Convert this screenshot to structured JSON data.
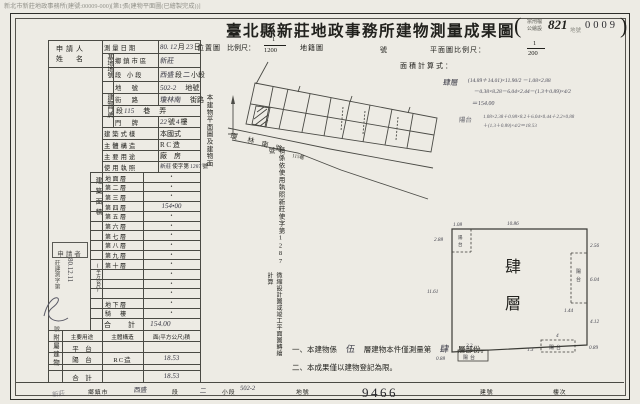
{
  "scan_header": "新北市新莊地政事務所(建號:00009-000)[第1張(建物平面圖(已繪製完成))]",
  "title": {
    "main": "臺北縣新莊地政事務所建物測量成果圖",
    "paren_open": "(",
    "paren_line1": "宗刑檔",
    "paren_line2": "公繪設",
    "file_number": "821",
    "registry_label": "地號",
    "page_number": "0009",
    "paren_close": ")"
  },
  "applicant": {
    "line1": "申請人",
    "line2": "姓　名"
  },
  "left_table": {
    "groups": [
      {
        "text": "基地地號",
        "y": 54,
        "h": 38
      },
      {
        "text": "建物門牌",
        "y": 94,
        "h": 32
      }
    ],
    "rows": [
      {
        "label": "測量日期",
        "segs": [
          {
            "t": "80.",
            "h": 1
          },
          {
            "t": "12",
            "h": 1
          },
          {
            "t": "月",
            "h": 0
          },
          {
            "t": "23",
            "h": 1
          },
          {
            "t": "日",
            "h": 0
          }
        ]
      },
      {
        "label": "鄉鎮市區",
        "inset": 1,
        "segs": [
          {
            "t": "新莊",
            "h": 1
          }
        ]
      },
      {
        "label": "段 小段",
        "inset": 1,
        "segs": [
          {
            "t": "西盛",
            "h": 1
          },
          {
            "t": "段",
            "h": 0
          },
          {
            "t": "二",
            "h": 1
          },
          {
            "t": "小段",
            "h": 0
          }
        ]
      },
      {
        "label": "地　號",
        "inset": 1,
        "segs": [
          {
            "t": "502-2",
            "h": 1
          },
          {
            "t": "地號",
            "h": 0,
            "gap": 1
          }
        ]
      },
      {
        "label": "街　路",
        "inset": 1,
        "segs": [
          {
            "t": "瓊林南",
            "h": 1
          },
          {
            "t": "街路",
            "h": 0,
            "gap": 1
          }
        ]
      },
      {
        "label": "",
        "inset": 1,
        "span": 1,
        "segs": [
          {
            "t": "段",
            "h": 0
          },
          {
            "t": "115",
            "h": 1
          },
          {
            "t": "巷",
            "h": 0,
            "gap": 1
          },
          {
            "t": "弄",
            "h": 0,
            "gap": 1
          }
        ]
      },
      {
        "label": "門　牌",
        "inset": 1,
        "segs": [
          {
            "t": "22",
            "h": 1
          },
          {
            "t": "號",
            "h": 0
          },
          {
            "t": "4",
            "h": 1
          },
          {
            "t": "樓",
            "h": 0
          }
        ]
      },
      {
        "label": "建築式樣",
        "segs": [
          {
            "t": "本國式",
            "h": 0
          }
        ]
      },
      {
        "label": "主體構造",
        "segs": [
          {
            "t": "R C 造",
            "h": 0
          }
        ]
      },
      {
        "label": "主要用途",
        "segs": [
          {
            "t": "廠　房",
            "h": 0
          }
        ]
      },
      {
        "label": "使用執照",
        "small": 1,
        "segs": [
          {
            "t": "新莊",
            "h": 1
          },
          {
            "t": "使字第",
            "h": 0
          },
          {
            "t": "1287",
            "h": 1
          },
          {
            "t": "號",
            "h": 0
          }
        ]
      }
    ]
  },
  "floors": {
    "side": "建築面積",
    "side_paren": "(平方公尺)",
    "rows": [
      {
        "name": "地面層",
        "value": "•"
      },
      {
        "name": "第二層",
        "value": "•"
      },
      {
        "name": "第三層",
        "value": "•"
      },
      {
        "name": "第四層",
        "value": "154•00",
        "hand": 1
      },
      {
        "name": "第五層",
        "value": "•"
      },
      {
        "name": "第六層",
        "value": "•"
      },
      {
        "name": "第七層",
        "value": "•"
      },
      {
        "name": "第八層",
        "value": "•"
      },
      {
        "name": "第九層",
        "value": "•"
      },
      {
        "name": "第十層",
        "value": "•"
      },
      {
        "name": "",
        "value": "•"
      },
      {
        "name": "",
        "value": "•"
      },
      {
        "name": "",
        "value": "•"
      },
      {
        "name": "地下層",
        "value": "•"
      },
      {
        "name": "騎　樓",
        "value": "•"
      }
    ],
    "total_label": "合　計",
    "total_value": "154.00"
  },
  "annex": {
    "side": "附屬建物",
    "headers": [
      "主要用途",
      "主體構造",
      "面(平方公尺)積"
    ],
    "rows": [
      {
        "use": "平　台",
        "struct": "",
        "area": ""
      },
      {
        "use": "陽　台",
        "struct": "RC造",
        "area": "18.53"
      },
      {
        "use": "",
        "struct": "",
        "area": ""
      },
      {
        "use": "合　計",
        "struct": "",
        "area": "18.53"
      }
    ]
  },
  "map_header": {
    "loc": "位置圖",
    "scale": "比例尺：",
    "num": "1",
    "den": "1200",
    "cad": "地籍圖",
    "suffix": "號"
  },
  "map": {
    "road_chars": [
      "瓊",
      "林",
      "南",
      "路"
    ],
    "lane": "115巷"
  },
  "plan_header": {
    "label": "平面圖比例尺：",
    "num": "1",
    "den": "200",
    "calc": "面積計算式："
  },
  "formulas": {
    "floor_label": "肆層",
    "floor_lines": [
      "(14.89＋14.01)×11.90/2 －1.08×2.88",
      "－0.38×8.28－6.04×2.44－(1.3＋0.89)×4/2",
      "＝154.00"
    ],
    "balcony_label": "陽台",
    "balcony_lines": [
      "1.08×2.38＋0.98×8.2＋6.04×0.44＋2.2×0.88",
      "＋(1.3＋0.89)×4/2＝18.53"
    ]
  },
  "vnote": {
    "col1": "本建物平面圖及建物面",
    "col2": "積係依使用執照新莊使字第1287號",
    "col3": "微縮設計圖或竣工平面圖轉繪計算"
  },
  "notes": {
    "n1_pre": "一、本建物係",
    "n1_hand1": "伍",
    "n1_mid": "層建物本件僅測量第",
    "n1_hand2": "肆",
    "n1_post": "層部份。",
    "n2": "二、本成果僅以建物登記為限。"
  },
  "stamp": {
    "title": "申請者",
    "serial": "莊建測字第",
    "serial_suffix": "號",
    "date": "80.12.11"
  },
  "plan": {
    "name_chars": [
      "肆",
      "層"
    ],
    "balcony_chars": [
      "陽",
      "台"
    ],
    "dims": [
      {
        "t": "1.08",
        "x": 453,
        "y": 226
      },
      {
        "t": "10.86",
        "x": 507,
        "y": 225
      },
      {
        "t": "2.88",
        "x": 434,
        "y": 241
      },
      {
        "t": "2.56",
        "x": 590,
        "y": 247
      },
      {
        "t": "6.04",
        "x": 590,
        "y": 281
      },
      {
        "t": "1.44",
        "x": 564,
        "y": 312
      },
      {
        "t": "4.12",
        "x": 590,
        "y": 323
      },
      {
        "t": "0.89",
        "x": 589,
        "y": 349
      },
      {
        "t": "11.61",
        "x": 427,
        "y": 293
      },
      {
        "t": "0.88",
        "x": 436,
        "y": 360
      },
      {
        "t": "2.2",
        "x": 466,
        "y": 347
      },
      {
        "t": "1.3",
        "x": 527,
        "y": 351
      },
      {
        "t": "4",
        "x": 556,
        "y": 337
      }
    ]
  },
  "bottom": {
    "labels": [
      "鄉鎮市",
      "段",
      "小段",
      "地號",
      "建號",
      "樓次"
    ],
    "values": [
      "新莊",
      "西盛",
      "二",
      "502-2",
      "9466"
    ]
  }
}
